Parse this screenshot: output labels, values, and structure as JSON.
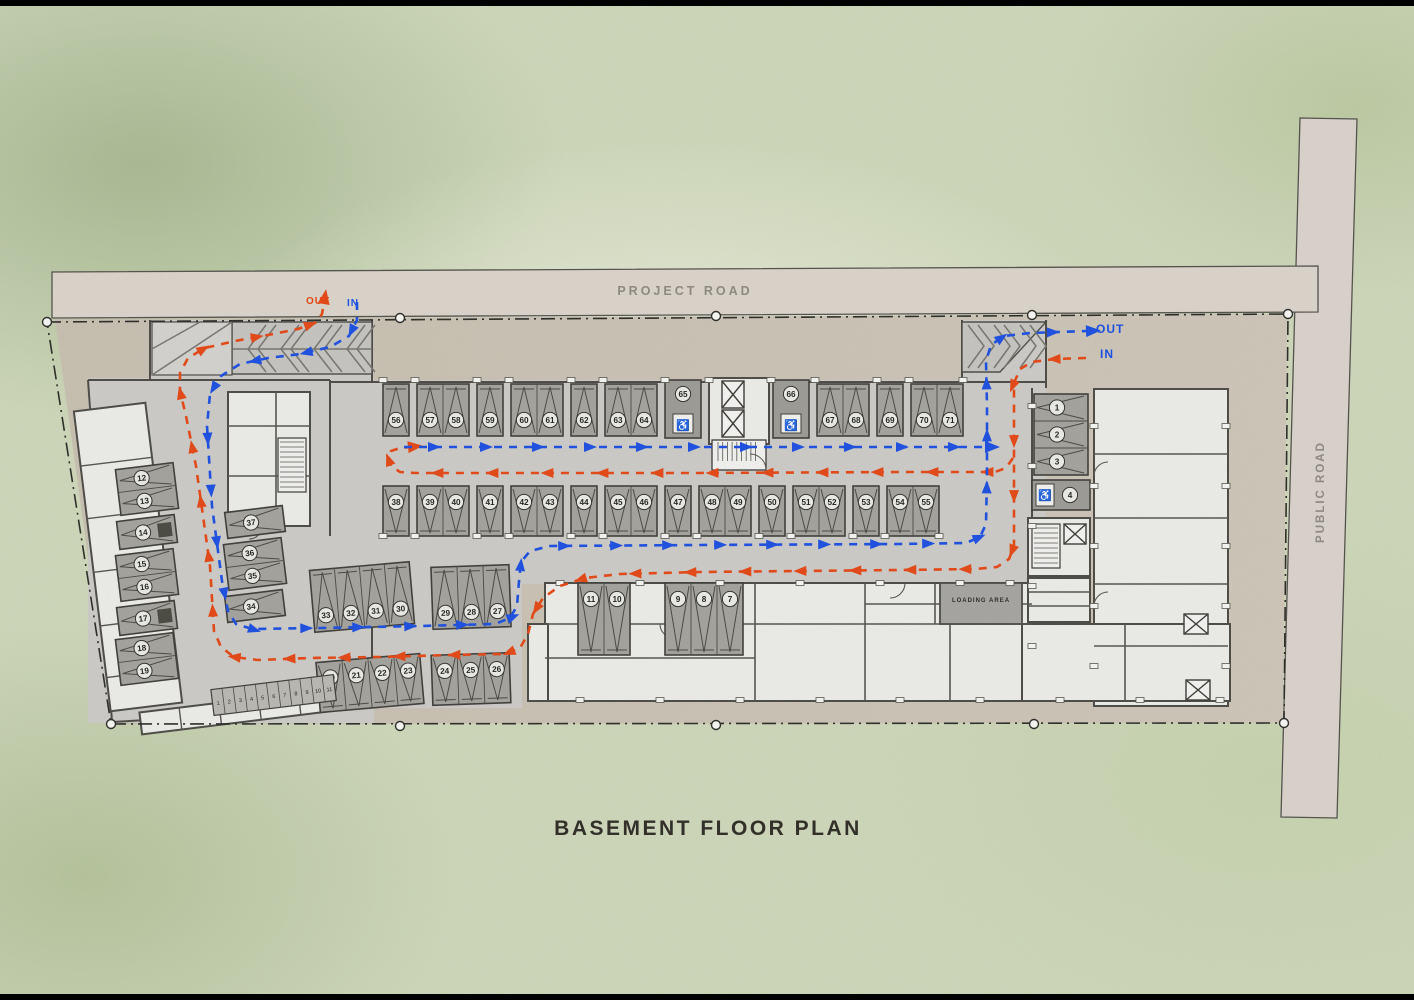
{
  "title": "BASEMENT FLOOR PLAN",
  "roads": {
    "top": "PROJECT ROAD",
    "right": "PUBLIC ROAD"
  },
  "flow": {
    "left": {
      "out": "OUT",
      "in": "IN"
    },
    "right": {
      "out": "OUT",
      "in": "IN"
    },
    "in_color": "#1d4fe0",
    "out_color": "#e34816"
  },
  "areas": {
    "loading": "LOADING AREA"
  },
  "stalls": {
    "top_row_groups": [
      [
        "56"
      ],
      [
        "57",
        "58"
      ],
      [
        "59"
      ],
      [
        "60",
        "61"
      ],
      [
        "62"
      ],
      [
        "63",
        "64"
      ],
      [
        "65"
      ],
      [
        "66"
      ],
      [
        "67",
        "68"
      ],
      [
        "69"
      ],
      [
        "70",
        "71"
      ]
    ],
    "mid_row_groups": [
      [
        "38"
      ],
      [
        "39",
        "40"
      ],
      [
        "41"
      ],
      [
        "42",
        "43"
      ],
      [
        "44"
      ],
      [
        "45",
        "46"
      ],
      [
        "47"
      ],
      [
        "48",
        "49"
      ],
      [
        "50"
      ],
      [
        "51",
        "52"
      ],
      [
        "53"
      ],
      [
        "54",
        "55"
      ]
    ],
    "row_30_33": [
      "33",
      "32",
      "31",
      "30"
    ],
    "row_27_29": [
      "29",
      "28",
      "27"
    ],
    "row_20_23": [
      "20",
      "21",
      "22",
      "23"
    ],
    "row_24_26": [
      "24",
      "25",
      "26"
    ],
    "row_10_11": [
      "11",
      "10"
    ],
    "row_7_9": [
      "9",
      "8",
      "7"
    ],
    "left_col_groups": [
      [
        "12",
        "13"
      ],
      [
        "14"
      ],
      [
        "15",
        "16"
      ],
      [
        "17"
      ],
      [
        "18",
        "19"
      ]
    ],
    "inner_col_groups": [
      [
        "37"
      ],
      [
        "36",
        "35"
      ],
      [
        "34"
      ]
    ],
    "right_col": [
      "1",
      "2",
      "3"
    ],
    "right_accessible": "4",
    "accessible_icon": "wheelchair",
    "moto_strip": [
      "1",
      "2",
      "3",
      "4",
      "5",
      "6",
      "7",
      "8",
      "9",
      "10",
      "11"
    ]
  }
}
